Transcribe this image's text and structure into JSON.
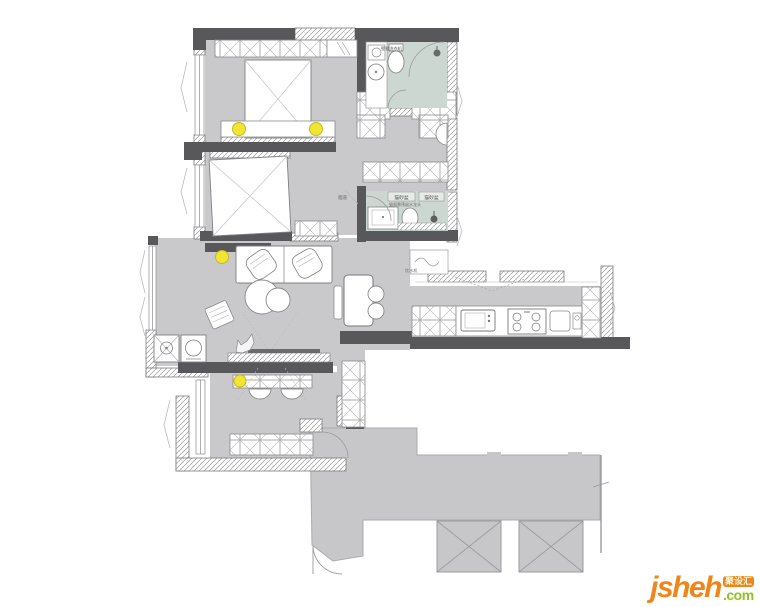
{
  "watermark": {
    "brand": "jsheh",
    "tld": ".com",
    "badge": "聚设汇"
  },
  "plan": {
    "labels": {
      "washing_machine": "壁挂洗衣机",
      "litter_boxes": [
        "猫砂盆",
        "猫砂盆"
      ],
      "litter_note": "猫厕需预留水龙头",
      "flue": "烟道",
      "water_dispenser": "饮水机"
    },
    "colors": {
      "wall": "#58585a",
      "floor": "#c9c9cb",
      "bath_floor": "#cdd7d1",
      "outside_area": "#c7c7c9",
      "ceiling_light": "#f2e432",
      "logo_orange": "#f08519",
      "logo_green": "#8fc31f"
    }
  }
}
